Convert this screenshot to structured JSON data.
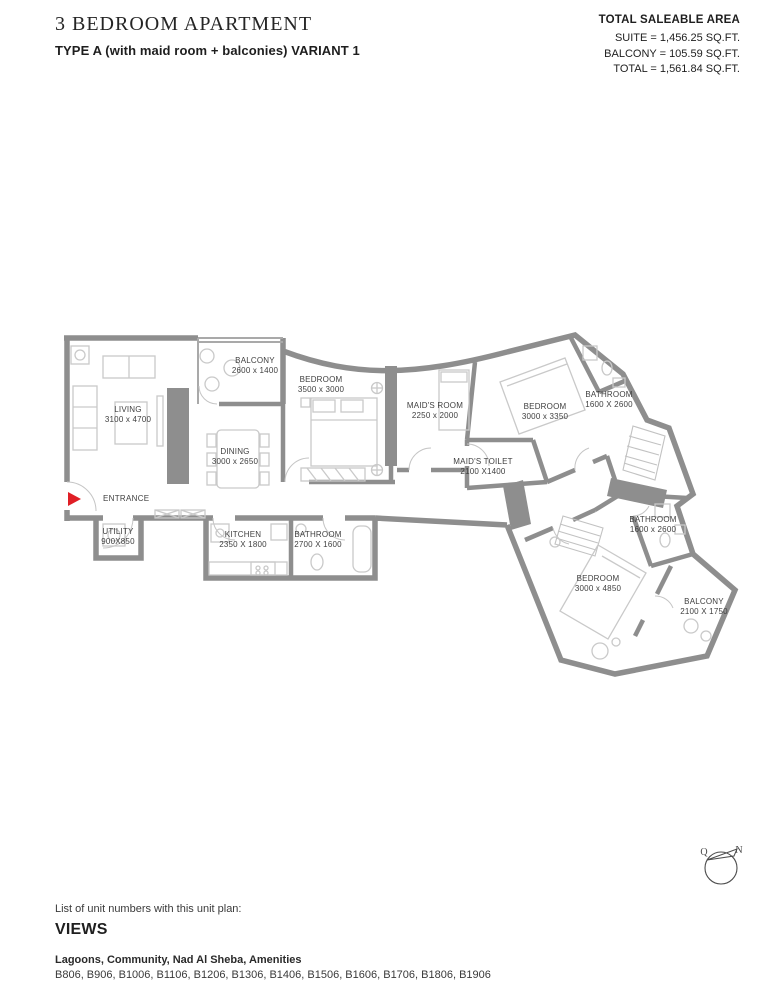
{
  "header": {
    "title": "3 BEDROOM APARTMENT",
    "subtitle": "TYPE A (with maid room + balconies) VARIANT 1",
    "area_summary": {
      "heading": "TOTAL SALEABLE AREA",
      "lines": [
        "SUITE = 1,456.25 SQ.FT.",
        "BALCONY = 105.59 SQ.FT.",
        "TOTAL = 1,561.84 SQ.FT."
      ]
    }
  },
  "plan": {
    "entrance_label": "ENTRANCE",
    "rooms": [
      {
        "name": "LIVING",
        "dims": "3100 x 4700",
        "x": 73,
        "y": 82
      },
      {
        "name": "BALCONY",
        "dims": "2600 x 1400",
        "x": 200,
        "y": 33
      },
      {
        "name": "BEDROOM",
        "dims": "3500 x 3000",
        "x": 266,
        "y": 52
      },
      {
        "name": "DINING",
        "dims": "3000 x 2650",
        "x": 180,
        "y": 124
      },
      {
        "name": "MAID'S ROOM",
        "dims": "2250 x 2000",
        "x": 380,
        "y": 78
      },
      {
        "name": "MAID'S TOILET",
        "dims": "2100 X1400",
        "x": 428,
        "y": 134
      },
      {
        "name": "BEDROOM",
        "dims": "3000 x 3350",
        "x": 490,
        "y": 79
      },
      {
        "name": "BATHROOM",
        "dims": "1600 X 2600",
        "x": 554,
        "y": 67
      },
      {
        "name": "UTILITY",
        "dims": "900X850",
        "x": 63,
        "y": 204
      },
      {
        "name": "KITCHEN",
        "dims": "2350 X 1800",
        "x": 188,
        "y": 207
      },
      {
        "name": "BATHROOM",
        "dims": "2700 X 1600",
        "x": 263,
        "y": 207
      },
      {
        "name": "BATHROOM",
        "dims": "1600 x 2600",
        "x": 598,
        "y": 192
      },
      {
        "name": "BEDROOM",
        "dims": "3000 x 4850",
        "x": 543,
        "y": 251
      },
      {
        "name": "BALCONY",
        "dims": "2100 X 1750",
        "x": 649,
        "y": 274
      }
    ],
    "compass": {
      "label_left": "Q",
      "label_right": "N"
    }
  },
  "footer": {
    "list_heading": "List of unit numbers with this unit plan:",
    "views_heading": "VIEWS",
    "views_list": "Lagoons, Community, Nad Al Sheba, Amenities",
    "unit_numbers": "B806, B906, B1006, B1106, B1206, B1306, B1406, B1506, B1606, B1706, B1806, B1906"
  },
  "colors": {
    "wall": "#8e8e8e",
    "furniture": "#c9c9c9",
    "entrance_arrow": "#e01f26",
    "text": "#2d2d2d"
  }
}
